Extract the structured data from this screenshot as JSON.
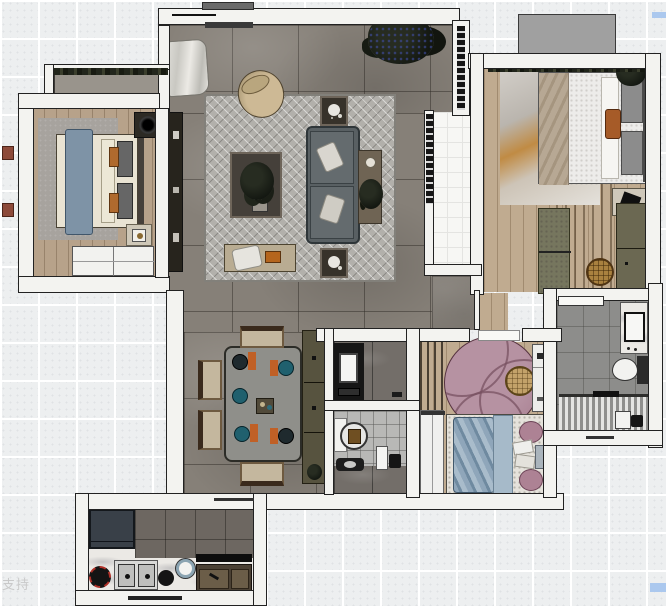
{
  "meta": {
    "title": "furnished-apartment-floor-plan-render",
    "view": "top-down",
    "canvas": {
      "width": 666,
      "height": 606
    }
  },
  "watermark": {
    "bottom_left_text": "支持",
    "color": "#c9c9c9",
    "highlight_color": "#abc8ee"
  },
  "palette": {
    "background_grid": "#edeff0",
    "wall": "#f3f3f0",
    "wall_outline": "#222222",
    "living_floor": "#868078",
    "wood_floor": "#c0ab90",
    "bedroom2_floor": "#b7a28a",
    "balcony_tile": "#f7f7f4",
    "master_bath_tile": "#8d8d8b",
    "small_bath_tile": "#b8b8b6",
    "kitchen_floor": "#6d6761",
    "counter_marble": "#ebe9e5",
    "sofa": "#596063",
    "kid_rug": "#b692a2",
    "blue_bedding": "#8fa6ba",
    "accent_orange": "#b06a2e",
    "sideboard_olive": "#57533f"
  },
  "rooms": [
    {
      "id": "living-room",
      "floor": "living_floor"
    },
    {
      "id": "dining-area",
      "floor": "living_floor"
    },
    {
      "id": "bedroom-left",
      "floor": "bedroom2_floor"
    },
    {
      "id": "master-bedroom",
      "floor": "wood_floor"
    },
    {
      "id": "kids-bedroom",
      "floor": "wood_floor"
    },
    {
      "id": "balcony",
      "floor": "balcony_tile"
    },
    {
      "id": "master-bathroom",
      "floor": "master_bath_tile"
    },
    {
      "id": "guest-bathroom",
      "floor": "small_bath_tile"
    },
    {
      "id": "laundry-vanity-room",
      "floor": "master_bath_tile"
    },
    {
      "id": "kitchen",
      "floor": "kitchen_floor"
    }
  ],
  "furniture_inventory": [
    "entry-door",
    "entry-curtain",
    "tv-console",
    "herringbone-rug",
    "round-armchair",
    "coffee-table",
    "sofa",
    "sofa-console",
    "side-table",
    "living-bench",
    "large-plant",
    "bed-left",
    "bed-master",
    "bed-kids",
    "wardrobe",
    "nightstand",
    "dresser-bench",
    "woven-pouf",
    "dining-table",
    "dining-chair",
    "sideboard",
    "round-rug",
    "desk-cabinet",
    "vanity-sink",
    "toilet",
    "shower",
    "washbasin",
    "refrigerator",
    "kitchen-sink",
    "gas-burner",
    "cooktop-cabinet",
    "kettle"
  ]
}
